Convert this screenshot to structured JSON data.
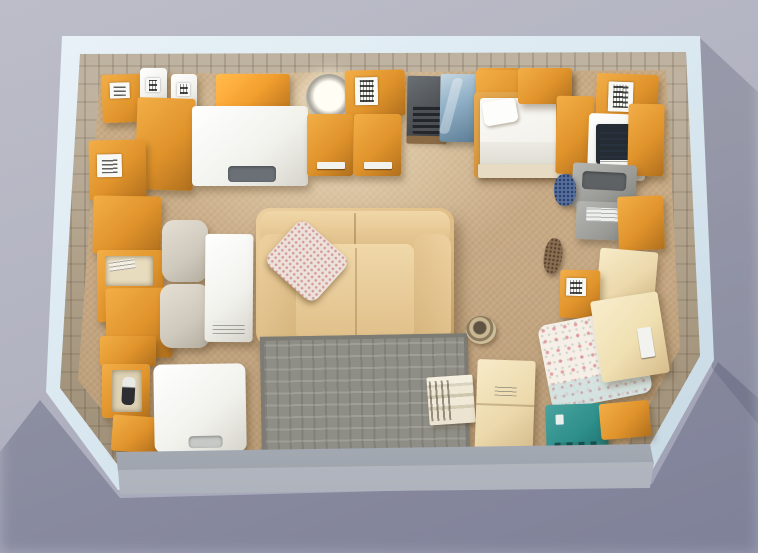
{
  "scene": {
    "description": "Top-down 3D rendering of an open self-storage unit densely packed with household furniture and cardboard moving boxes; light blue-white unit frame on a lavender-gray ground, tan carpeted floor, open front with a metal door rail at the bottom edge.",
    "setting": "storage-unit",
    "view": "top-down",
    "objects": {
      "frame": {
        "label": "storage unit outer frame"
      },
      "walls": {
        "label": "corrugated interior walls"
      },
      "floor": {
        "label": "tan carpet floor"
      },
      "rail": {
        "label": "roll-up door rail at open front"
      },
      "sofa": {
        "label": "tan leather sofa seen from above"
      },
      "sofa_pillow": {
        "label": "floral throw pillow on sofa"
      },
      "rug": {
        "label": "gray patterned area rug"
      },
      "basket": {
        "label": "small round wicker basket"
      },
      "books": {
        "label": "stack of books and papers"
      },
      "washer": {
        "label": "white appliance (washer/freezer) top"
      },
      "mirror": {
        "label": "round mirror with coiled rope frame"
      },
      "moving_box": {
        "label": "orange cardboard moving box"
      },
      "box_label": {
        "label": "white shipping label with markings"
      },
      "jug": {
        "label": "small white carton"
      },
      "open_box": {
        "label": "open moving box with contents"
      },
      "bottle_box": {
        "label": "open box holding a bottle"
      },
      "fridge": {
        "label": "white mini fridge"
      },
      "ottoman": {
        "label": "upholstered ottoman"
      },
      "tall_white_box": {
        "label": "tall white box"
      },
      "file_cabinet": {
        "label": "orange cabinet with handle"
      },
      "dark_appliance": {
        "label": "dark gray appliance with grill"
      },
      "blue_cabinet": {
        "label": "glossy blue-gray cabinet"
      },
      "bed": {
        "label": "single bed with white mattress"
      },
      "bed_pillow": {
        "label": "white bed pillow"
      },
      "desk": {
        "label": "white desk"
      },
      "monitor": {
        "label": "computer monitor on desk"
      },
      "printer": {
        "label": "gray printer"
      },
      "copier": {
        "label": "gray copier with paper tray"
      },
      "plush_blue": {
        "label": "bundle of blue fabric"
      },
      "plush_dog": {
        "label": "brown plush toy"
      },
      "cream_box_mid": {
        "label": "cream cardboard box"
      },
      "cream_box_large": {
        "label": "large cream box resting on armchair"
      },
      "floral_chair": {
        "label": "floral upholstered armchair"
      },
      "teal_bin": {
        "label": "teal storage bin"
      },
      "cream_box_bottom": {
        "label": "large cream moving box near front"
      }
    }
  },
  "palette": {
    "bg-top": "#bcbdc8",
    "bg-bottom": "#9b9db2",
    "frame": "#dce9f1",
    "wall": "#b3a48d",
    "wall-dark": "#6f6554",
    "floor": "#c6a883",
    "box": "#e0932b",
    "box-hi": "#f3ae47",
    "box-lo": "#b06f1d",
    "cream": "#ecd9ac",
    "sofa": "#ddba82",
    "rug": "#8f8e86",
    "teal": "#2e8f8b",
    "blue-cab": "#8fb0c6",
    "dark-appl": "#4d5156",
    "white-obj": "#f1f1ec"
  }
}
